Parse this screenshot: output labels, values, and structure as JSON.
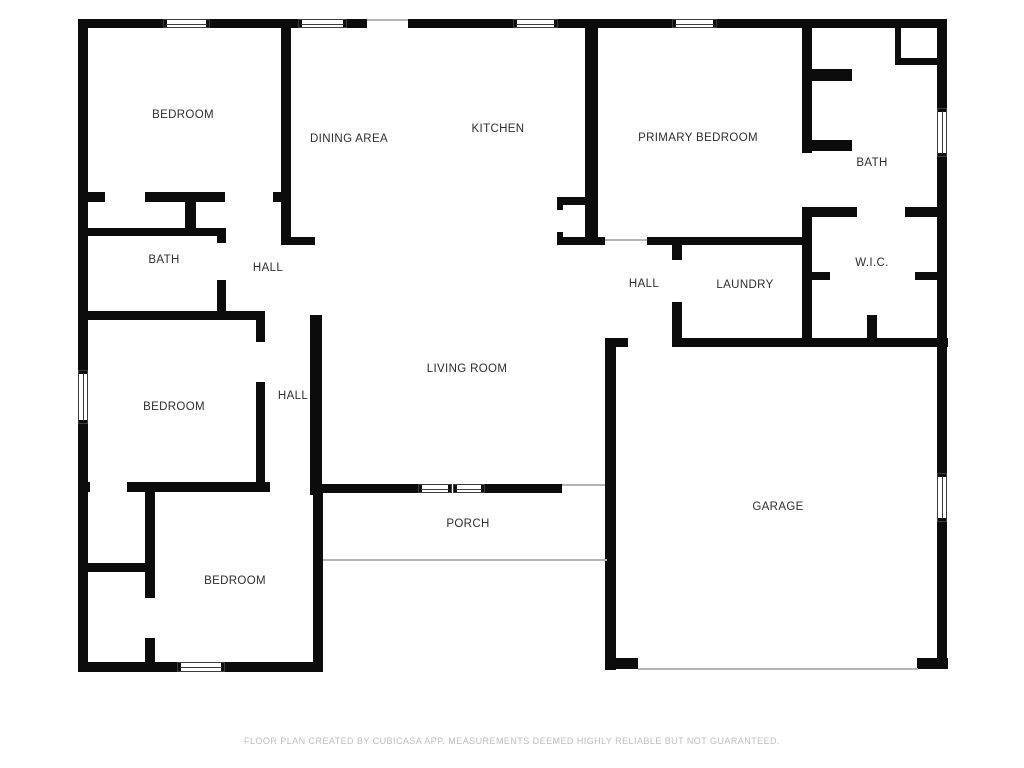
{
  "page": {
    "background": "#ffffff"
  },
  "floorplan": {
    "canvas": {
      "width": 1024,
      "height": 768
    },
    "colors": {
      "wall": "#0c0c0c",
      "window_frame": "#3c3c3c",
      "thin_line": "#b5b5b5",
      "label": "#2e2e2e",
      "footer": "#bdbdbd"
    },
    "rooms": [
      {
        "id": "bedroom-top-left",
        "name": "BEDROOM",
        "x": 183,
        "y": 115
      },
      {
        "id": "dining-area",
        "name": "DINING AREA",
        "x": 349,
        "y": 139
      },
      {
        "id": "kitchen",
        "name": "KITCHEN",
        "x": 498,
        "y": 129
      },
      {
        "id": "primary-bedroom",
        "name": "PRIMARY BEDROOM",
        "x": 698,
        "y": 138
      },
      {
        "id": "bath-right",
        "name": "BATH",
        "x": 872,
        "y": 163
      },
      {
        "id": "wic",
        "name": "W.I.C.",
        "x": 872,
        "y": 263
      },
      {
        "id": "bath-left",
        "name": "BATH",
        "x": 164,
        "y": 260
      },
      {
        "id": "hall-upper-left",
        "name": "HALL",
        "x": 268,
        "y": 268
      },
      {
        "id": "hall-right",
        "name": "HALL",
        "x": 644,
        "y": 284
      },
      {
        "id": "laundry",
        "name": "LAUNDRY",
        "x": 745,
        "y": 285
      },
      {
        "id": "bedroom-middle-left",
        "name": "BEDROOM",
        "x": 174,
        "y": 407
      },
      {
        "id": "hall-middle",
        "name": "HALL",
        "x": 293,
        "y": 396
      },
      {
        "id": "living-room",
        "name": "LIVING ROOM",
        "x": 467,
        "y": 369
      },
      {
        "id": "porch",
        "name": "PORCH",
        "x": 468,
        "y": 524
      },
      {
        "id": "bedroom-bottom",
        "name": "BEDROOM",
        "x": 235,
        "y": 581
      },
      {
        "id": "garage",
        "name": "GARAGE",
        "x": 778,
        "y": 507
      }
    ],
    "walls": [
      [
        78,
        19,
        85,
        9
      ],
      [
        210,
        19,
        88,
        9
      ],
      [
        347,
        19,
        20,
        9
      ],
      [
        408,
        19,
        105,
        9
      ],
      [
        558,
        19,
        114,
        9
      ],
      [
        717,
        19,
        230,
        9
      ],
      [
        78,
        19,
        10,
        351
      ],
      [
        78,
        424,
        10,
        248
      ],
      [
        937,
        19,
        10,
        89
      ],
      [
        937,
        157,
        10,
        316
      ],
      [
        937,
        522,
        10,
        146
      ],
      [
        78,
        662,
        99,
        10
      ],
      [
        225,
        662,
        98,
        10
      ],
      [
        607,
        658,
        31,
        11
      ],
      [
        917,
        658,
        31,
        11
      ],
      [
        313,
        484,
        10,
        186
      ],
      [
        605,
        338,
        11,
        332
      ],
      [
        616,
        338,
        12,
        9
      ],
      [
        281,
        19,
        10,
        226
      ],
      [
        281,
        237,
        34,
        8
      ],
      [
        88,
        192,
        17,
        10
      ],
      [
        145,
        192,
        80,
        10
      ],
      [
        273,
        192,
        9,
        10
      ],
      [
        185,
        192,
        11,
        36
      ],
      [
        88,
        228,
        136,
        8
      ],
      [
        217,
        228,
        9,
        15
      ],
      [
        217,
        280,
        9,
        38
      ],
      [
        88,
        311,
        177,
        9
      ],
      [
        256,
        311,
        9,
        31
      ],
      [
        256,
        382,
        9,
        105
      ],
      [
        78,
        482,
        12,
        10
      ],
      [
        127,
        482,
        143,
        10
      ],
      [
        310,
        315,
        12,
        180
      ],
      [
        310,
        484,
        108,
        9
      ],
      [
        485,
        484,
        77,
        9
      ],
      [
        78,
        563,
        67,
        9
      ],
      [
        145,
        490,
        10,
        108
      ],
      [
        145,
        638,
        10,
        24
      ],
      [
        585,
        19,
        13,
        218
      ],
      [
        557,
        197,
        28,
        8
      ],
      [
        557,
        197,
        6,
        13
      ],
      [
        557,
        232,
        6,
        13
      ],
      [
        557,
        237,
        48,
        8
      ],
      [
        647,
        237,
        161,
        8
      ],
      [
        672,
        245,
        10,
        15
      ],
      [
        672,
        302,
        10,
        45
      ],
      [
        802,
        19,
        10,
        134
      ],
      [
        802,
        208,
        10,
        139
      ],
      [
        812,
        69,
        40,
        12
      ],
      [
        812,
        140,
        40,
        11
      ],
      [
        895,
        28,
        6,
        30
      ],
      [
        895,
        58,
        42,
        7
      ],
      [
        802,
        207,
        55,
        10
      ],
      [
        905,
        207,
        32,
        10
      ],
      [
        812,
        272,
        18,
        8
      ],
      [
        915,
        272,
        22,
        8
      ],
      [
        867,
        315,
        10,
        23
      ],
      [
        672,
        338,
        276,
        9
      ]
    ],
    "windows": [
      {
        "x": 163,
        "y": 19,
        "w": 47,
        "h": 9,
        "o": "h"
      },
      {
        "x": 298,
        "y": 19,
        "w": 49,
        "h": 9,
        "o": "h"
      },
      {
        "x": 513,
        "y": 19,
        "w": 45,
        "h": 9,
        "o": "h"
      },
      {
        "x": 672,
        "y": 19,
        "w": 45,
        "h": 9,
        "o": "h"
      },
      {
        "x": 937,
        "y": 108,
        "w": 10,
        "h": 49,
        "o": "v"
      },
      {
        "x": 78,
        "y": 370,
        "w": 10,
        "h": 54,
        "o": "v"
      },
      {
        "x": 177,
        "y": 662,
        "w": 48,
        "h": 10,
        "o": "h"
      },
      {
        "x": 937,
        "y": 473,
        "w": 10,
        "h": 49,
        "o": "v"
      },
      {
        "x": 418,
        "y": 484,
        "w": 34,
        "h": 9,
        "o": "h"
      },
      {
        "x": 453,
        "y": 484,
        "w": 32,
        "h": 9,
        "o": "h"
      }
    ],
    "thin_lines": [
      [
        367,
        19,
        41,
        2
      ],
      [
        605,
        239,
        42,
        2
      ],
      [
        562,
        484,
        43,
        2
      ],
      [
        323,
        559,
        284,
        2
      ],
      [
        638,
        668,
        280,
        2
      ]
    ]
  },
  "footer": {
    "disclaimer": "FLOOR PLAN CREATED BY CUBICASA APP. MEASUREMENTS DEEMED HIGHLY RELIABLE BUT NOT GUARANTEED."
  }
}
